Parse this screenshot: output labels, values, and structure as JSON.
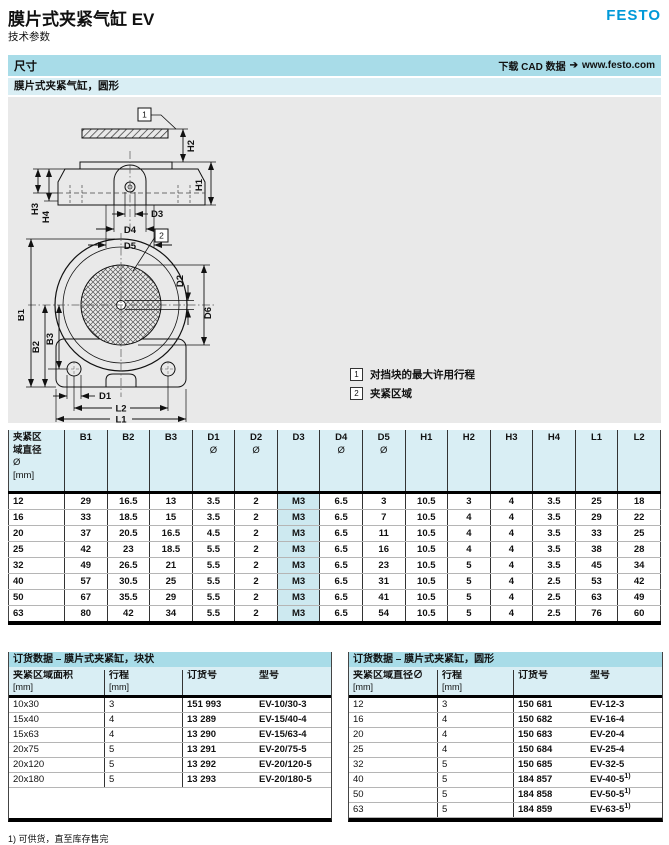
{
  "header": {
    "title": "膜片式夹紧气缸 EV",
    "subtitle": "技术参数",
    "brand": "FESTO"
  },
  "toolbar": {
    "section": "尺寸",
    "cad_label": "下载 CAD 数据",
    "cad_arrow": "➔",
    "cad_url": "www.festo.com",
    "subsection": "膜片式夹紧气缸，圆形"
  },
  "drawing": {
    "markers": {
      "m1": "1",
      "m2": "2"
    },
    "side_labels": {
      "H1": "H1",
      "H2": "H2",
      "H3": "H3",
      "H4": "H4",
      "D3": "D3",
      "D4": "D4",
      "D5": "D5"
    },
    "top_labels": {
      "B1": "B1",
      "B2": "B2",
      "B3": "B3",
      "D1": "D1",
      "D2": "D2",
      "D6": "D6",
      "L1": "L1",
      "L2": "L2"
    },
    "legend": [
      {
        "marker": "1",
        "text": "对挡块的最大许用行程"
      },
      {
        "marker": "2",
        "text": "夹紧区域"
      }
    ]
  },
  "dim_table": {
    "col1_lines": [
      "夹紧区",
      "域直径",
      "Ø",
      "[mm]"
    ],
    "columns": [
      {
        "label": "B1",
        "sub": ""
      },
      {
        "label": "B2",
        "sub": ""
      },
      {
        "label": "B3",
        "sub": ""
      },
      {
        "label": "D1",
        "sub": "Ø"
      },
      {
        "label": "D2",
        "sub": "Ø"
      },
      {
        "label": "D3",
        "sub": ""
      },
      {
        "label": "D4",
        "sub": "Ø"
      },
      {
        "label": "D5",
        "sub": "Ø"
      },
      {
        "label": "H1",
        "sub": ""
      },
      {
        "label": "H2",
        "sub": ""
      },
      {
        "label": "H3",
        "sub": ""
      },
      {
        "label": "H4",
        "sub": ""
      },
      {
        "label": "L1",
        "sub": ""
      },
      {
        "label": "L2",
        "sub": ""
      }
    ],
    "highlight_col": 6,
    "rows": [
      [
        "12",
        "29",
        "16.5",
        "13",
        "3.5",
        "2",
        "M3",
        "6.5",
        "3",
        "10.5",
        "3",
        "4",
        "3.5",
        "25",
        "18"
      ],
      [
        "16",
        "33",
        "18.5",
        "15",
        "3.5",
        "2",
        "M3",
        "6.5",
        "7",
        "10.5",
        "4",
        "4",
        "3.5",
        "29",
        "22"
      ],
      [
        "20",
        "37",
        "20.5",
        "16.5",
        "4.5",
        "2",
        "M3",
        "6.5",
        "11",
        "10.5",
        "4",
        "4",
        "3.5",
        "33",
        "25"
      ],
      [
        "25",
        "42",
        "23",
        "18.5",
        "5.5",
        "2",
        "M3",
        "6.5",
        "16",
        "10.5",
        "4",
        "4",
        "3.5",
        "38",
        "28"
      ],
      [
        "32",
        "49",
        "26.5",
        "21",
        "5.5",
        "2",
        "M3",
        "6.5",
        "23",
        "10.5",
        "5",
        "4",
        "3.5",
        "45",
        "34"
      ],
      [
        "40",
        "57",
        "30.5",
        "25",
        "5.5",
        "2",
        "M3",
        "6.5",
        "31",
        "10.5",
        "5",
        "4",
        "2.5",
        "53",
        "42"
      ],
      [
        "50",
        "67",
        "35.5",
        "29",
        "5.5",
        "2",
        "M3",
        "6.5",
        "41",
        "10.5",
        "5",
        "4",
        "2.5",
        "63",
        "49"
      ],
      [
        "63",
        "80",
        "42",
        "34",
        "5.5",
        "2",
        "M3",
        "6.5",
        "54",
        "10.5",
        "5",
        "4",
        "2.5",
        "76",
        "60"
      ]
    ]
  },
  "order_tables": {
    "left": {
      "title": "订货数据 – 膜片式夹紧缸，块状",
      "headers": [
        [
          "夹紧区域面积",
          "[mm]"
        ],
        [
          "行程",
          "[mm]"
        ],
        [
          "订货号",
          ""
        ],
        [
          "型号",
          ""
        ]
      ],
      "rows": [
        [
          "10x30",
          "3",
          "151 993",
          "EV-10/30-3"
        ],
        [
          "15x40",
          "4",
          "13 289",
          "EV-15/40-4"
        ],
        [
          "15x63",
          "4",
          "13 290",
          "EV-15/63-4"
        ],
        [
          "20x75",
          "5",
          "13 291",
          "EV-20/75-5"
        ],
        [
          "20x120",
          "5",
          "13 292",
          "EV-20/120-5"
        ],
        [
          "20x180",
          "5",
          "13 293",
          "EV-20/180-5"
        ]
      ]
    },
    "right": {
      "title": "订货数据 – 膜片式夹紧缸，圆形",
      "headers": [
        [
          "夹紧区域直径∅",
          "[mm]"
        ],
        [
          "行程",
          "[mm]"
        ],
        [
          "订货号",
          ""
        ],
        [
          "型号",
          ""
        ]
      ],
      "rows": [
        [
          "12",
          "3",
          "150 681",
          "EV-12-3"
        ],
        [
          "16",
          "4",
          "150 682",
          "EV-16-4"
        ],
        [
          "20",
          "4",
          "150 683",
          "EV-20-4"
        ],
        [
          "25",
          "4",
          "150 684",
          "EV-25-4"
        ],
        [
          "32",
          "5",
          "150 685",
          "EV-32-5"
        ],
        [
          "40",
          "5",
          "184 857",
          "EV-40-5",
          "1)"
        ],
        [
          "50",
          "5",
          "184 858",
          "EV-50-5",
          "1)"
        ],
        [
          "63",
          "5",
          "184 859",
          "EV-63-5",
          "1)"
        ]
      ]
    }
  },
  "footnote": "1) 可供货，直至库存售完",
  "colors": {
    "accent": "#0099d8",
    "bar": "#a8dce8",
    "bar_light": "#d9eef4",
    "highlight": "#cde9f0",
    "drawing_bg": "#e9e9e9"
  }
}
